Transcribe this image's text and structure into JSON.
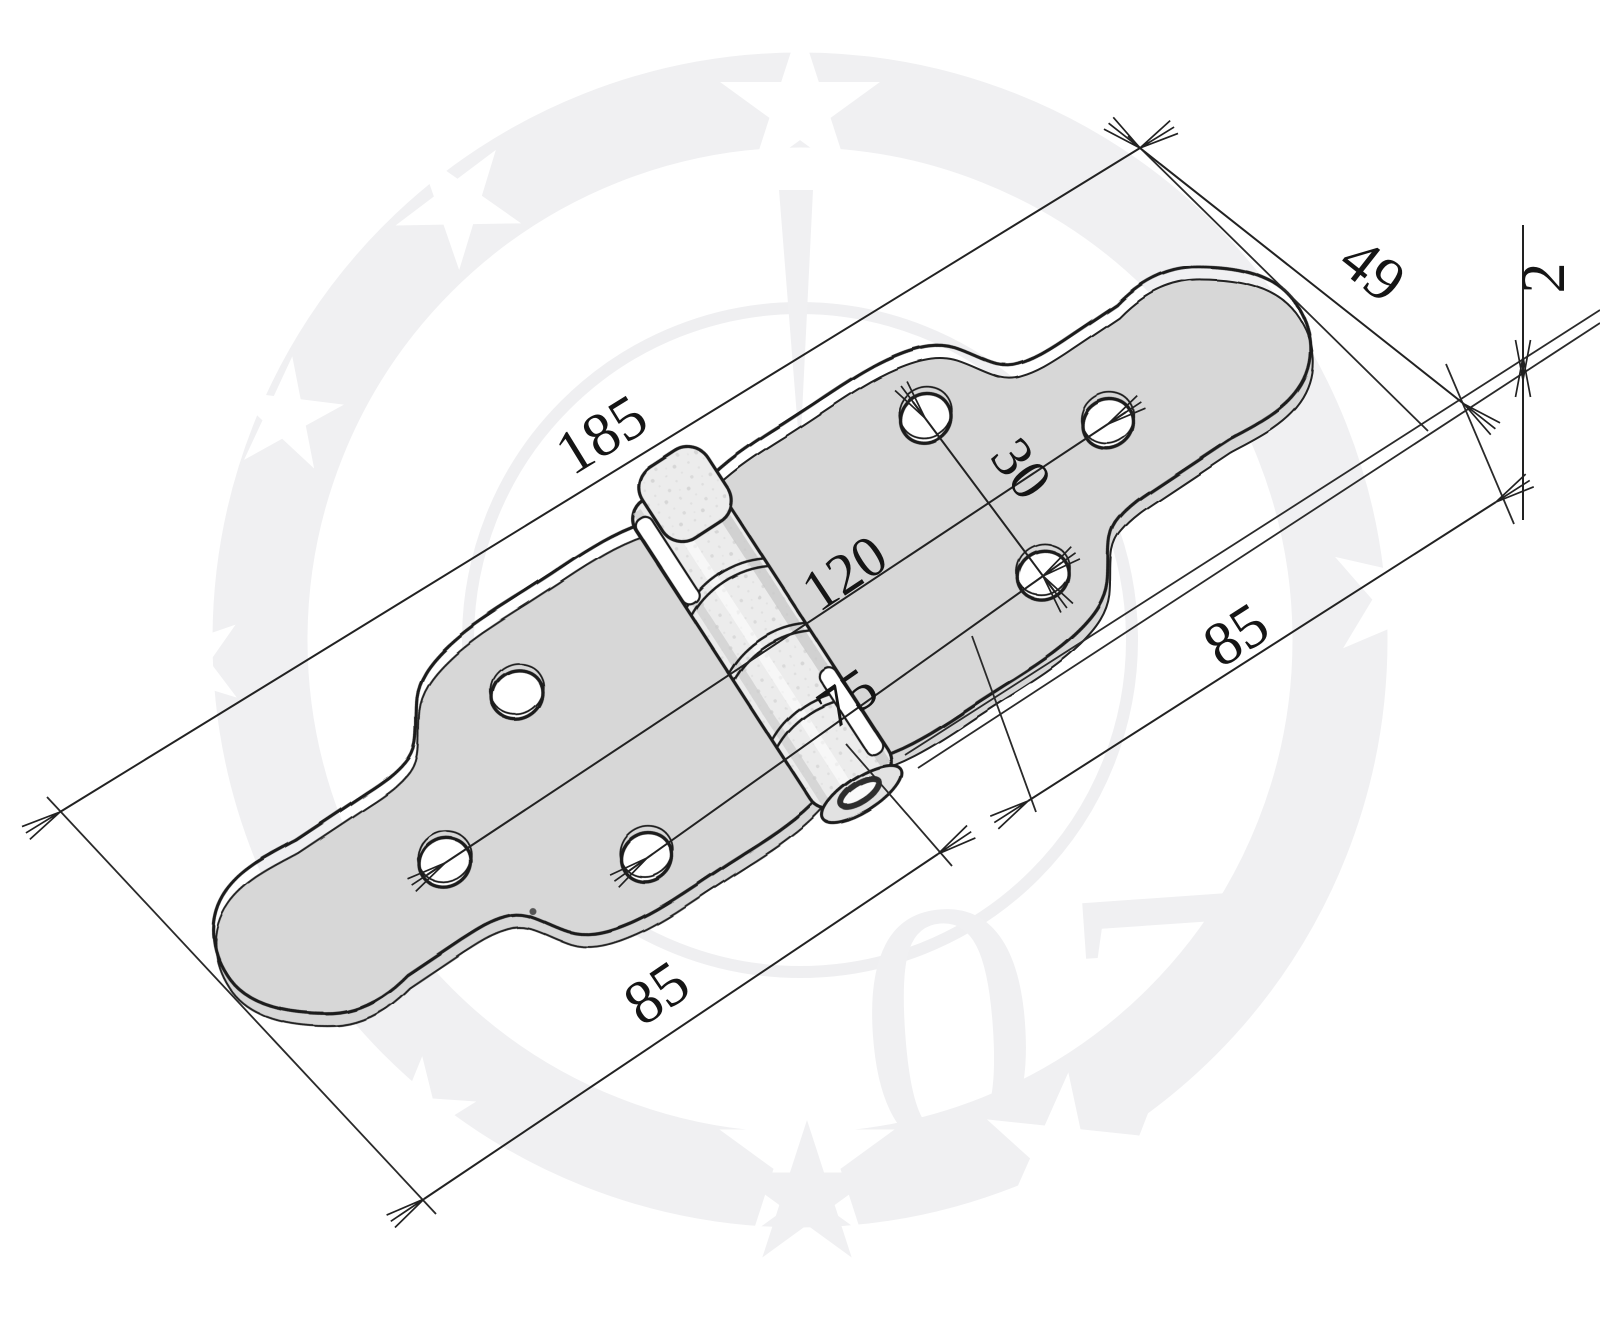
{
  "drawing": {
    "kind_label": "",
    "dims": {
      "overall_length": "185",
      "end_width": "49",
      "thickness": "2",
      "hole_offset": "30",
      "hole_span_outer": "120",
      "hole_span_inner": "75",
      "leaf_length_right": "85",
      "leaf_length_left": "85"
    },
    "watermark_text": "07",
    "colors": {
      "background": "#ffffff",
      "line": "#222222",
      "text": "#151515",
      "plate_fill": "#ececec",
      "plate_shadow": "#d7d7d7",
      "watermark": "#f0f0f2"
    }
  }
}
